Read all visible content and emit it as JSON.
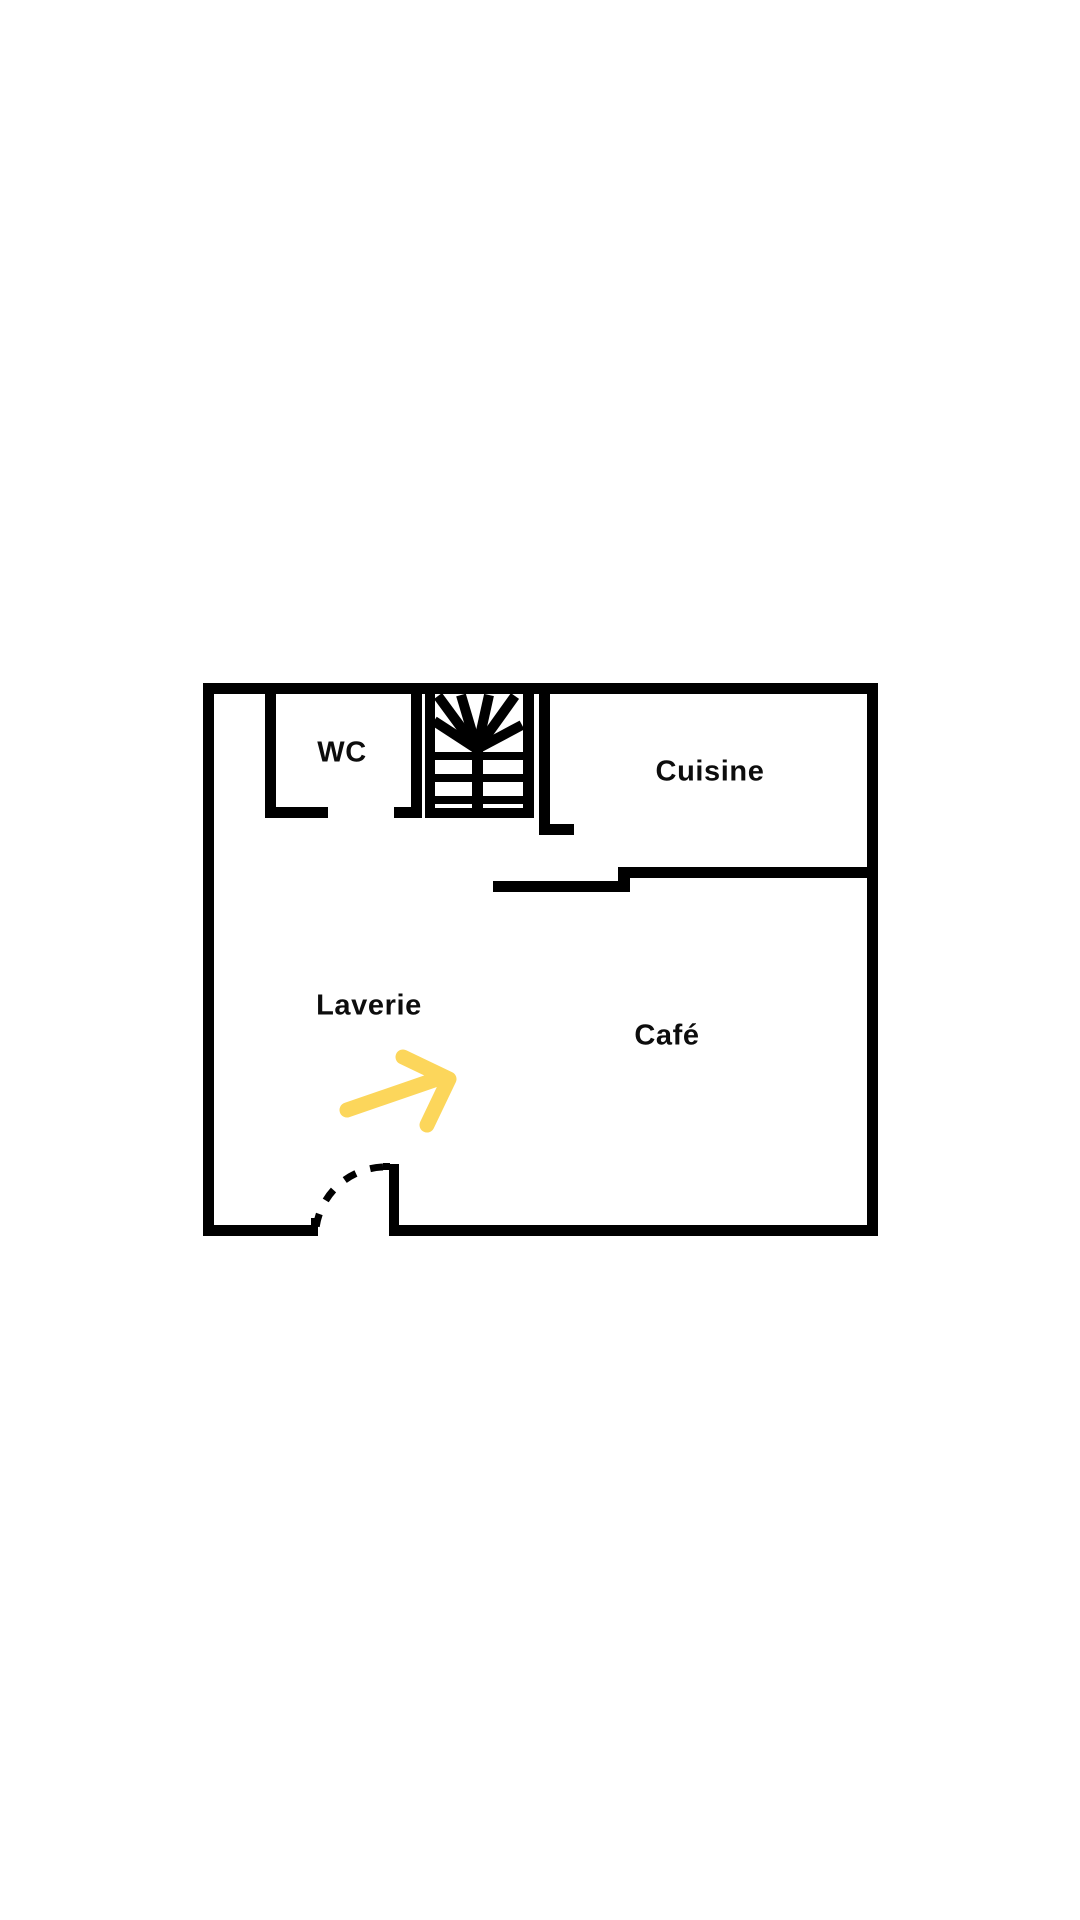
{
  "page": {
    "background": "#ffffff",
    "title": "Floor plan"
  },
  "palette": {
    "wall": "#000000",
    "arrow": "#FCD65B",
    "text": "#0d0d0d"
  },
  "rooms": [
    {
      "id": "wc",
      "label": "WC",
      "cx": 342,
      "cy": 753
    },
    {
      "id": "cuisine",
      "label": "Cuisine",
      "cx": 710,
      "cy": 772
    },
    {
      "id": "laverie",
      "label": "Laverie",
      "cx": 369,
      "cy": 1006
    },
    {
      "id": "cafe",
      "label": "Café",
      "cx": 667,
      "cy": 1036
    }
  ],
  "plan": {
    "walls": [
      [
        203,
        683,
        675,
        11
      ],
      [
        203,
        683,
        11,
        553
      ],
      [
        867,
        683,
        11,
        553
      ],
      [
        203,
        1225,
        115,
        11
      ],
      [
        311,
        1218,
        8,
        8
      ],
      [
        389,
        1225,
        489,
        11
      ],
      [
        265,
        694,
        11,
        124
      ],
      [
        265,
        807,
        63,
        11
      ],
      [
        411,
        694,
        11,
        124
      ],
      [
        394,
        807,
        28,
        11
      ],
      [
        425,
        694,
        10,
        124
      ],
      [
        523,
        694,
        11,
        124
      ],
      [
        425,
        808,
        109,
        10
      ],
      [
        472,
        746,
        11,
        70
      ],
      [
        539,
        694,
        11,
        140
      ],
      [
        539,
        824,
        35,
        11
      ],
      [
        618,
        867,
        250,
        11
      ],
      [
        618,
        867,
        12,
        25
      ],
      [
        493,
        881,
        137,
        11
      ]
    ],
    "stairs": {
      "treads": [
        [
          435,
          752,
          88,
          8
        ],
        [
          435,
          774,
          88,
          8
        ],
        [
          435,
          796,
          88,
          8
        ]
      ],
      "rays": [
        [
          477,
          749,
          434,
          721
        ],
        [
          477,
          749,
          438,
          696
        ],
        [
          477,
          749,
          461,
          695
        ],
        [
          477,
          749,
          489,
          695
        ],
        [
          477,
          749,
          515,
          696
        ],
        [
          477,
          749,
          522,
          725
        ]
      ],
      "ray_width": 10
    },
    "door": {
      "leaf": [
        389,
        1164,
        10,
        72
      ],
      "leaf_tick": [
        383,
        1163,
        7,
        7
      ],
      "swing_path": "M 383 1167 A 70 70 0 0 0 316 1228",
      "swing_dash": "13 15",
      "swing_width": 7
    },
    "arrow": {
      "shaft": [
        347,
        1110,
        437,
        1079
      ],
      "head_points": "403,1057 449,1079 427,1125",
      "stroke_width": 15
    }
  }
}
